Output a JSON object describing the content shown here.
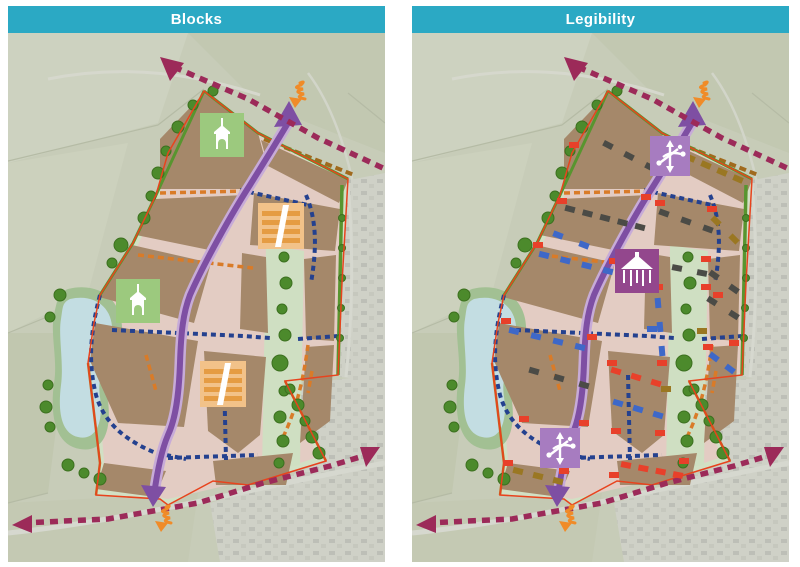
{
  "panels": {
    "left": {
      "title": "Blocks"
    },
    "right": {
      "title": "Legibility"
    }
  },
  "colors": {
    "header_teal": "#2ba9c4",
    "aerial_field": "#c7ccb8",
    "aerial_light": "#d3d6c8",
    "housing_gray": "#c6c8c0",
    "site_green": "#d2e0c4",
    "street_pink": "#e3ccc3",
    "block_brown": "#a5886a",
    "corridor_green": "#cfdfc2",
    "pond_blue": "#c3dde2",
    "pond_edge_green": "#a2c093",
    "boundary_red": "#e8431d",
    "hedgerow_green": "#58952f",
    "tree_green": "#4c8a2c",
    "main_route_purple": "#7e4fa3",
    "main_route_casing": "#c7abd8",
    "existing_route_magenta": "#9c2a59",
    "secondary_route_blue": "#24418f",
    "tertiary_route_orange": "#d97b28",
    "lane_olive": "#a06a1d",
    "gateway_orange": "#f08b28",
    "icon_church_bg": "#9cc97e",
    "icon_mews_bg": "#f2c289",
    "icon_mews_stripe": "#e59c43",
    "icon_junction_bg": "#a77cc0",
    "icon_bandstand_bg": "#93478d",
    "bld_red": "#e8402a",
    "bld_blue": "#3e68c8",
    "bld_gray": "#4b4b46",
    "bld_olive": "#9a7722"
  },
  "icons": {
    "blocks_panel": [
      "church-icon",
      "church-icon",
      "mews-grid-icon",
      "mews-grid-icon",
      "gateway-spring-icon",
      "gateway-spring-icon"
    ],
    "legibility_panel": [
      "junction-node-icon",
      "junction-node-icon",
      "bandstand-icon",
      "gateway-spring-icon",
      "gateway-spring-icon"
    ]
  },
  "legibility_buildings": {
    "size": {
      "w": 10,
      "h": 6
    },
    "rows": [
      {
        "x1": 196,
        "y1": 112,
        "x2": 238,
        "y2": 134,
        "n": 3,
        "c": "gray"
      },
      {
        "x1": 262,
        "y1": 118,
        "x2": 326,
        "y2": 146,
        "n": 5,
        "c": "olive"
      },
      {
        "x1": 158,
        "y1": 176,
        "x2": 228,
        "y2": 194,
        "n": 5,
        "c": "gray"
      },
      {
        "x1": 146,
        "y1": 202,
        "x2": 172,
        "y2": 212,
        "n": 2,
        "c": "blue"
      },
      {
        "x1": 252,
        "y1": 180,
        "x2": 296,
        "y2": 196,
        "n": 3,
        "c": "gray"
      },
      {
        "x1": 304,
        "y1": 188,
        "x2": 322,
        "y2": 206,
        "n": 2,
        "c": "olive"
      },
      {
        "x1": 132,
        "y1": 222,
        "x2": 196,
        "y2": 238,
        "n": 4,
        "c": "blue"
      },
      {
        "x1": 240,
        "y1": 230,
        "x2": 290,
        "y2": 240,
        "n": 3,
        "c": "gray"
      },
      {
        "x1": 302,
        "y1": 242,
        "x2": 322,
        "y2": 256,
        "n": 2,
        "c": "gray"
      },
      {
        "x1": 102,
        "y1": 298,
        "x2": 168,
        "y2": 314,
        "n": 4,
        "c": "blue"
      },
      {
        "x1": 122,
        "y1": 338,
        "x2": 172,
        "y2": 352,
        "n": 3,
        "c": "gray"
      },
      {
        "x1": 246,
        "y1": 270,
        "x2": 250,
        "y2": 318,
        "n": 3,
        "c": "blue"
      },
      {
        "x1": 300,
        "y1": 268,
        "x2": 322,
        "y2": 282,
        "n": 2,
        "c": "gray"
      },
      {
        "x1": 302,
        "y1": 324,
        "x2": 318,
        "y2": 336,
        "n": 2,
        "c": "blue"
      },
      {
        "x1": 204,
        "y1": 338,
        "x2": 244,
        "y2": 350,
        "n": 3,
        "c": "red"
      },
      {
        "x1": 206,
        "y1": 370,
        "x2": 246,
        "y2": 382,
        "n": 3,
        "c": "blue"
      },
      {
        "x1": 214,
        "y1": 432,
        "x2": 266,
        "y2": 442,
        "n": 4,
        "c": "red"
      },
      {
        "x1": 106,
        "y1": 438,
        "x2": 146,
        "y2": 448,
        "n": 3,
        "c": "olive"
      }
    ],
    "singles": [
      [
        162,
        112,
        "red"
      ],
      [
        250,
        108,
        "red"
      ],
      [
        150,
        168,
        "red"
      ],
      [
        234,
        164,
        "red"
      ],
      [
        248,
        170,
        "red"
      ],
      [
        300,
        176,
        "red"
      ],
      [
        126,
        212,
        "red"
      ],
      [
        202,
        228,
        "red"
      ],
      [
        94,
        288,
        "red"
      ],
      [
        180,
        304,
        "red"
      ],
      [
        238,
        222,
        "red"
      ],
      [
        294,
        226,
        "red"
      ],
      [
        246,
        254,
        "red"
      ],
      [
        294,
        254,
        "red"
      ],
      [
        200,
        330,
        "red"
      ],
      [
        250,
        330,
        "red"
      ],
      [
        112,
        386,
        "red"
      ],
      [
        172,
        390,
        "red"
      ],
      [
        204,
        398,
        "red"
      ],
      [
        248,
        400,
        "red"
      ],
      [
        296,
        314,
        "red"
      ],
      [
        322,
        310,
        "red"
      ],
      [
        306,
        262,
        "red"
      ],
      [
        96,
        430,
        "red"
      ],
      [
        152,
        438,
        "red"
      ],
      [
        272,
        428,
        "red"
      ],
      [
        202,
        442,
        "red"
      ],
      [
        240,
        296,
        "blue"
      ],
      [
        290,
        298,
        "olive"
      ],
      [
        254,
        356,
        "olive"
      ]
    ]
  }
}
